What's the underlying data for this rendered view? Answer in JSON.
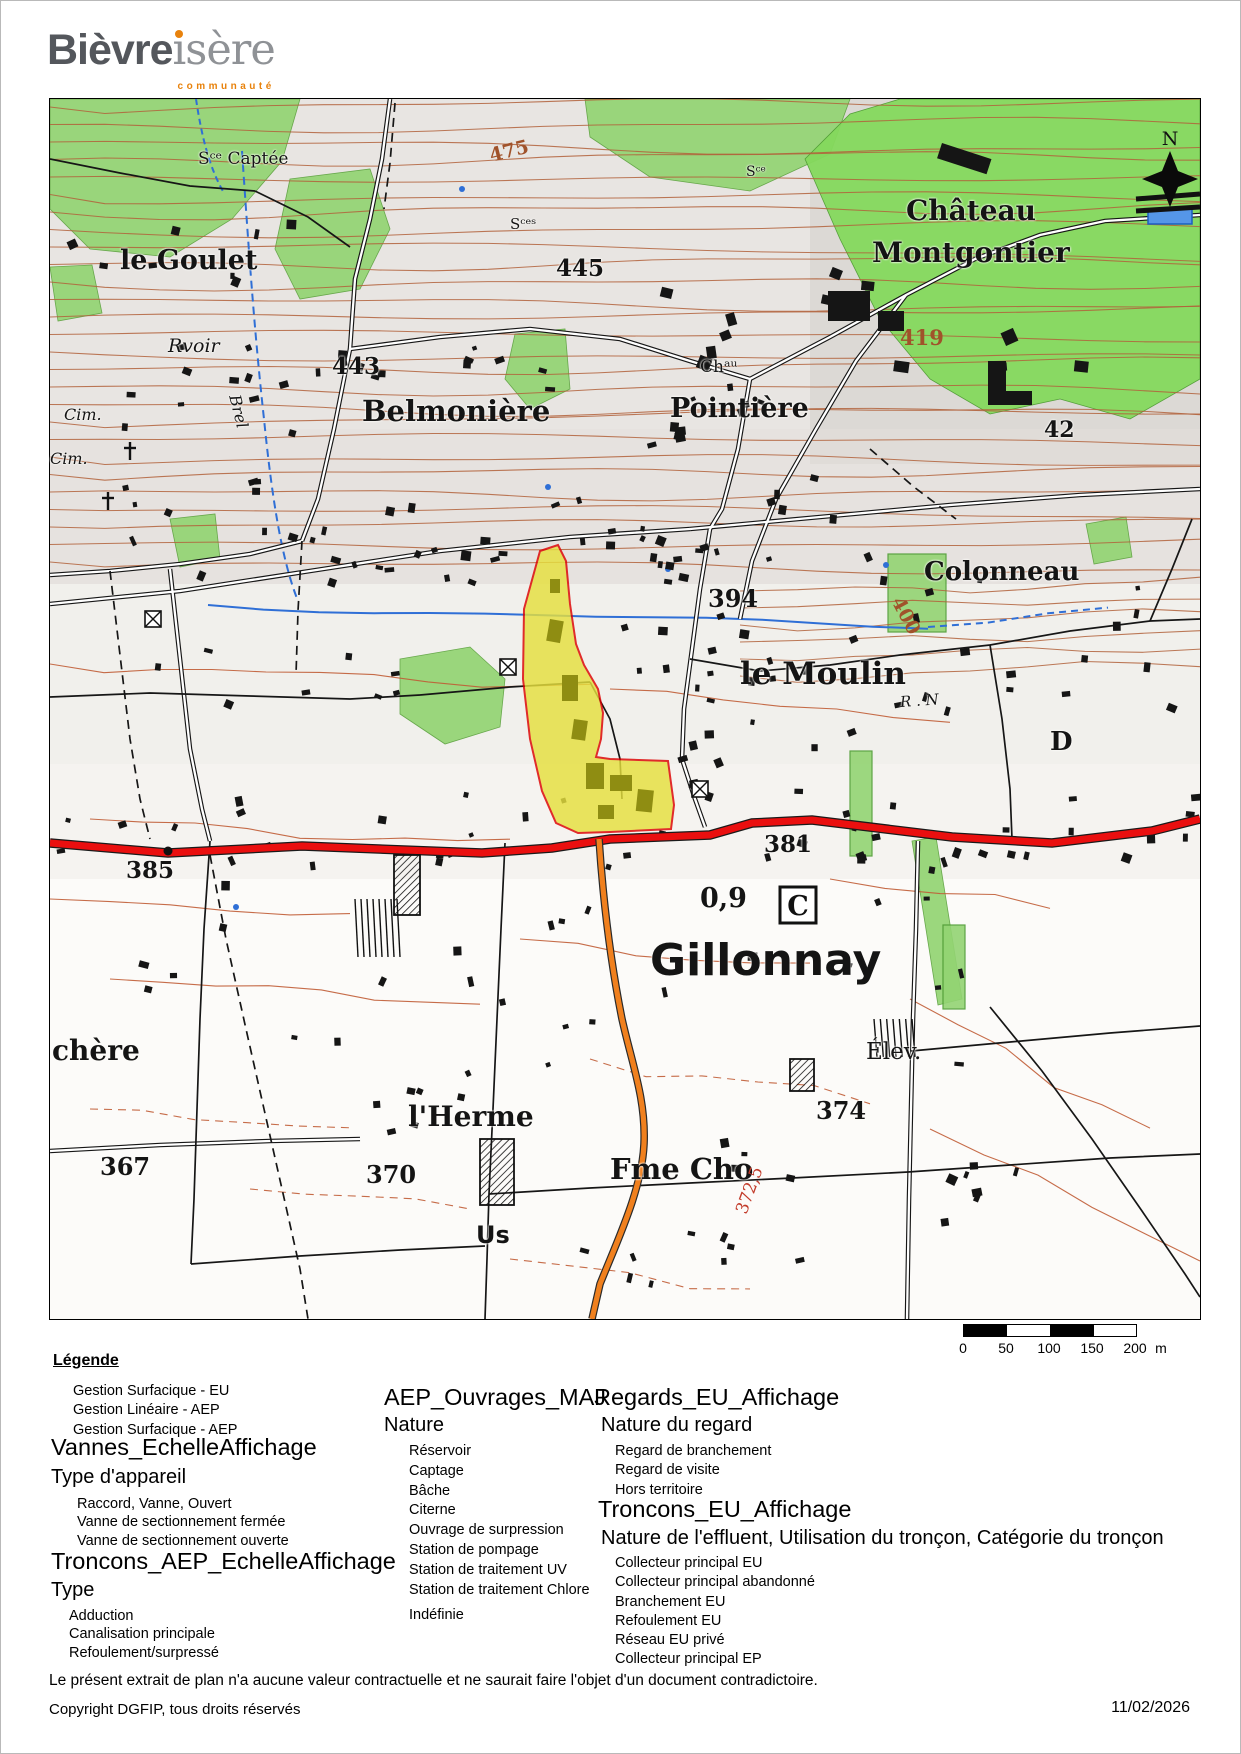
{
  "logo": {
    "part1": "Bièvre",
    "part2": "sère",
    "tagline": "communauté",
    "orange": "#e8820c"
  },
  "map": {
    "colors": {
      "red_road": "#ea0f0f",
      "orange_road": "#f0801e",
      "parcel_yellow": "#e6e03e",
      "parcel_outline": "#dd0000",
      "veg_green": "#93d473",
      "veg_bright": "#85d95d",
      "contour_brown": "#b2613b",
      "water_blue": "#2f6fd6"
    },
    "north_label": "N",
    "c_label": "C",
    "labels": [
      {
        "text": "Sᶜᵉ Captée",
        "x": 148,
        "y": 52,
        "size": 17,
        "cls": "serif"
      },
      {
        "text": "475",
        "x": 440,
        "y": 48,
        "size": 19,
        "cls": "contour-label",
        "rot": -14
      },
      {
        "text": "le Goulet",
        "x": 70,
        "y": 148,
        "size": 27
      },
      {
        "text": "445",
        "x": 506,
        "y": 158,
        "size": 23
      },
      {
        "text": "Château",
        "x": 856,
        "y": 98,
        "size": 28
      },
      {
        "text": "Montgontier",
        "x": 822,
        "y": 140,
        "size": 28
      },
      {
        "text": "419",
        "x": 850,
        "y": 228,
        "size": 21,
        "cls": "contour-label"
      },
      {
        "text": "Sᶜᵉˢ",
        "x": 460,
        "y": 118,
        "size": 15,
        "cls": "serif"
      },
      {
        "text": "Sᶜᵉ",
        "x": 696,
        "y": 66,
        "size": 14,
        "cls": "serif"
      },
      {
        "text": "Rvoir",
        "x": 118,
        "y": 238,
        "size": 19,
        "cls": "ital"
      },
      {
        "text": "Brel",
        "x": 184,
        "y": 288,
        "size": 16,
        "cls": "ital",
        "rot": 76
      },
      {
        "text": "443",
        "x": 282,
        "y": 256,
        "size": 23
      },
      {
        "text": "Belmonière",
        "x": 312,
        "y": 298,
        "size": 29
      },
      {
        "text": "Chᵃᵘ",
        "x": 650,
        "y": 260,
        "size": 17,
        "cls": "serif"
      },
      {
        "text": "Pointière",
        "x": 620,
        "y": 296,
        "size": 27
      },
      {
        "text": "42",
        "x": 994,
        "y": 320,
        "size": 22
      },
      {
        "text": "Cim.",
        "x": 14,
        "y": 308,
        "size": 16,
        "cls": "ital"
      },
      {
        "text": "Cim.",
        "x": 0,
        "y": 352,
        "size": 16,
        "cls": "ital"
      },
      {
        "text": "394",
        "x": 658,
        "y": 488,
        "size": 24
      },
      {
        "text": "400",
        "x": 846,
        "y": 490,
        "size": 19,
        "cls": "contour-label",
        "rot": 62
      },
      {
        "text": "Colonneau",
        "x": 874,
        "y": 460,
        "size": 26
      },
      {
        "text": "le Moulin",
        "x": 690,
        "y": 560,
        "size": 31
      },
      {
        "text": "R . N",
        "x": 850,
        "y": 596,
        "size": 15,
        "cls": "ital",
        "rot": -4
      },
      {
        "text": "D",
        "x": 1000,
        "y": 630,
        "size": 26
      },
      {
        "text": "385",
        "x": 76,
        "y": 760,
        "size": 23
      },
      {
        "text": "381",
        "x": 714,
        "y": 734,
        "size": 23
      },
      {
        "text": "0,9",
        "x": 650,
        "y": 786,
        "size": 27
      },
      {
        "text": "Gillonnay",
        "x": 600,
        "y": 840,
        "size": 44,
        "cls": "sans"
      },
      {
        "text": "chère",
        "x": 2,
        "y": 938,
        "size": 28
      },
      {
        "text": "Élev.",
        "x": 816,
        "y": 942,
        "size": 23,
        "cls": "serif"
      },
      {
        "text": "374",
        "x": 766,
        "y": 1000,
        "size": 24
      },
      {
        "text": "l'Herme",
        "x": 358,
        "y": 1004,
        "size": 28
      },
      {
        "text": "367",
        "x": 50,
        "y": 1056,
        "size": 24
      },
      {
        "text": "370",
        "x": 316,
        "y": 1064,
        "size": 24
      },
      {
        "text": "Us",
        "x": 426,
        "y": 1124,
        "size": 24,
        "cls": "sans"
      },
      {
        "text": "Fme Cho",
        "x": 560,
        "y": 1056,
        "size": 29
      },
      {
        "text": "372,5",
        "x": 692,
        "y": 1106,
        "size": 17,
        "cls": "red-label",
        "rot": -70
      }
    ]
  },
  "scale_bar": {
    "ticks": [
      "0",
      "50",
      "100",
      "150",
      "200"
    ],
    "unit": "m"
  },
  "legend": {
    "title": "Légende",
    "col1": {
      "surface_items": [
        "Gestion Surfacique - EU",
        "Gestion Linéaire - AEP",
        "Gestion Surfacique - AEP"
      ],
      "vannes_heading": "Vannes_EchelleAffichage",
      "vannes_sub": "Type d'appareil",
      "vannes_items": [
        "Raccord, Vanne, Ouvert",
        "Vanne de sectionnement fermée",
        "Vanne de sectionnement ouverte"
      ],
      "troncons_heading": "Troncons_AEP_EchelleAffichage",
      "troncons_sub": "Type",
      "troncons_items": [
        "Adduction",
        "Canalisation principale",
        "Refoulement/surpressé"
      ]
    },
    "col2": {
      "heading": "AEP_Ouvrages_MAJ",
      "sub": "Nature",
      "items": [
        "Réservoir",
        "Captage",
        "Bâche",
        "Citerne",
        "Ouvrage de surpression",
        "Station de pompage",
        "Station de traitement UV",
        "Station de traitement Chlore"
      ],
      "last_item": "Indéfinie"
    },
    "col3": {
      "regards_heading": "Regards_EU_Affichage",
      "regards_sub": "Nature du regard",
      "regards_items": [
        "Regard de branchement",
        "Regard de visite",
        "Hors territoire"
      ],
      "troncons_heading": "Troncons_EU_Affichage",
      "troncons_sub": "Nature de l'effluent, Utilisation du tronçon, Catégorie du tronçon",
      "troncons_items": [
        "Collecteur principal EU",
        "Collecteur principal abandonné",
        "Branchement EU",
        "Refoulement EU",
        "Réseau EU privé",
        "Collecteur principal EP"
      ]
    }
  },
  "footer": {
    "disclaimer": "Le présent extrait de plan n'a aucune valeur contractuelle et ne saurait faire l'objet d'un document contradictoire.",
    "copyright": "Copyright DGFIP, tous droits réservés",
    "date": "11/02/2026"
  }
}
